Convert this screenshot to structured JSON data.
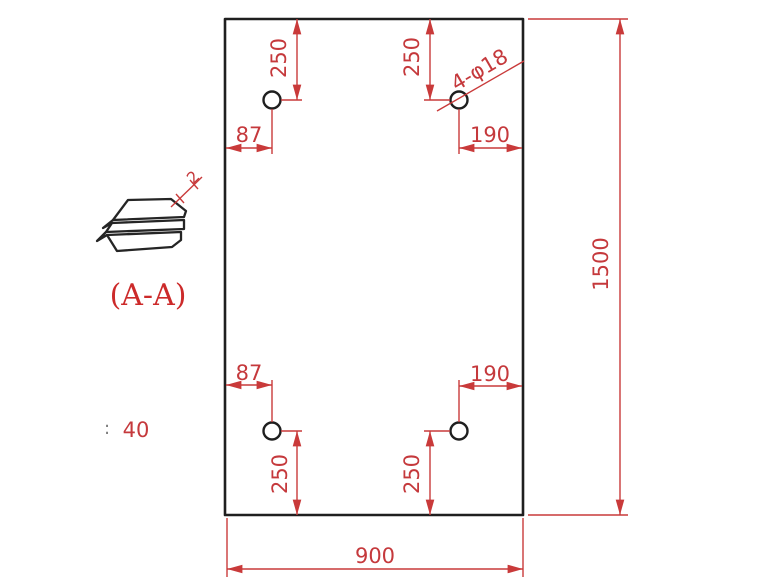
{
  "drawing": {
    "type": "engineering-drawing",
    "description": "Rectangular plate front view with four drilled holes, overall dimensions, and a section view sketch"
  },
  "plate": {
    "outline": {
      "width_label": "900",
      "height_label": "1500"
    },
    "holes": {
      "callout": "4-φ18",
      "count": 4,
      "diameter_mm": 18,
      "offset_top": "250",
      "offset_bottom": "250",
      "offset_left": "87",
      "offset_right": "190"
    }
  },
  "section_view": {
    "title": "(A-A)",
    "thickness_label": "2"
  },
  "note": {
    "colon": ":",
    "value": "40"
  },
  "colors": {
    "dimension_red": "#c93a3a",
    "text_red": "#c5393c",
    "outline_black": "#1f1f1f",
    "background": "#ffffff"
  }
}
